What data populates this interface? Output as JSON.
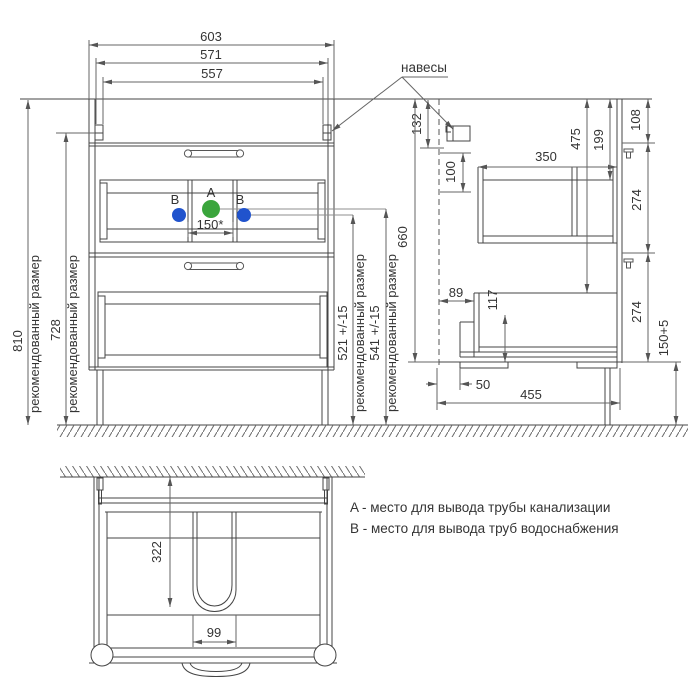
{
  "meta": {
    "pipe_a_color": "#3aa53c",
    "pipe_b_color": "#2053cd"
  },
  "front_view": {
    "width_outer": "603",
    "width_mid": "571",
    "width_inner": "557",
    "height_total": "810",
    "height_hanger": "728",
    "recommended_1": "рекомендованный размер",
    "recommended_2": "рекомендованный размер",
    "recommended_3": "рекомендованный размер",
    "recommended_4": "рекомендованный размер",
    "h521": "521 +/-15",
    "h541": "541 +/-15",
    "pipe_spacing": "150*",
    "pipe_a_label": "A",
    "pipe_b_label_left": "B",
    "pipe_b_label_right": "B"
  },
  "side_view": {
    "hangers_label": "навесы",
    "d132": "132",
    "d100": "100",
    "d350": "350",
    "d475": "475",
    "d199": "199",
    "d108": "108",
    "d274_top": "274",
    "d274_bottom": "274",
    "d660": "660",
    "d89": "89",
    "d117": "117",
    "d50": "50",
    "d455": "455",
    "d_plinth": "150+5"
  },
  "top_view": {
    "d322": "322",
    "d99": "99"
  },
  "legend": {
    "line_a": "A - место для вывода трубы канализации",
    "line_b": "B - место для вывода труб водоснабжения"
  }
}
